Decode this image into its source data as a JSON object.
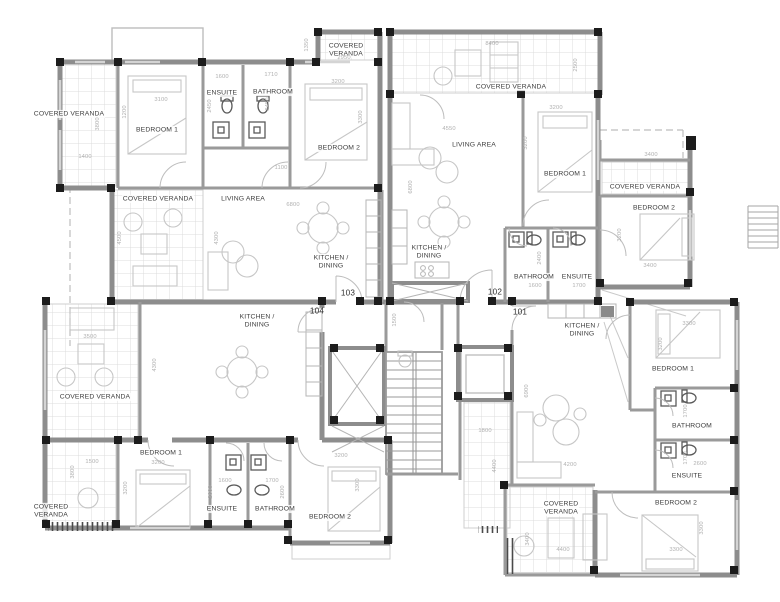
{
  "document": {
    "drawing_type": "apartment floor plan",
    "apartment_units": [
      "101",
      "102",
      "103",
      "104"
    ]
  },
  "colors": {
    "background": "#ffffff",
    "wall_gray": "#8d8d8d",
    "column_black": "#1c1c1c",
    "interior_wall": "#9a9a9a",
    "grid_gray": "#d9d9d9",
    "furniture_gray": "#c6c6c6",
    "dimension_text": "#b0b0b0",
    "room_text": "#3d3d3d"
  },
  "labels": {
    "rooms": [
      {
        "name": "apt103-covered-veranda-left",
        "text": "COVERED VERANDA",
        "x": 69,
        "y": 114
      },
      {
        "name": "apt103-bedroom1",
        "text": "BEDROOM 1",
        "x": 157,
        "y": 130
      },
      {
        "name": "apt103-ensuite",
        "text": "ENSUITE",
        "x": 222,
        "y": 93
      },
      {
        "name": "apt103-bathroom",
        "text": "BATHROOM",
        "x": 273,
        "y": 92
      },
      {
        "name": "apt103-bedroom2",
        "text": "BEDROOM 2",
        "x": 339,
        "y": 148
      },
      {
        "name": "apt103-covered-veranda-top",
        "text": "COVERED\nVERANDA",
        "x": 346,
        "y": 50
      },
      {
        "name": "apt103-covered-veranda-mid",
        "text": "COVERED VERANDA",
        "x": 158,
        "y": 199
      },
      {
        "name": "apt103-living-area",
        "text": "LIVING AREA",
        "x": 243,
        "y": 199
      },
      {
        "name": "apt103-kitchen-dining",
        "text": "KITCHEN /\nDINING",
        "x": 331,
        "y": 262
      },
      {
        "name": "apt102-covered-veranda-top",
        "text": "COVERED VERANDA",
        "x": 511,
        "y": 87
      },
      {
        "name": "apt102-living-area",
        "text": "LIVING AREA",
        "x": 474,
        "y": 145
      },
      {
        "name": "apt102-kitchen-dining",
        "text": "KITCHEN /\nDINING",
        "x": 429,
        "y": 252
      },
      {
        "name": "apt102-bedroom1",
        "text": "BEDROOM 1",
        "x": 565,
        "y": 174
      },
      {
        "name": "apt102-covered-veranda-right",
        "text": "COVERED VERANDA",
        "x": 645,
        "y": 187
      },
      {
        "name": "apt102-bedroom2",
        "text": "BEDROOM 2",
        "x": 654,
        "y": 208
      },
      {
        "name": "apt102-bathroom",
        "text": "BATHROOM",
        "x": 534,
        "y": 277
      },
      {
        "name": "apt102-ensuite",
        "text": "ENSUITE",
        "x": 577,
        "y": 277
      },
      {
        "name": "apt101-kitchen-dining",
        "text": "KITCHEN /\nDINING",
        "x": 582,
        "y": 330
      },
      {
        "name": "apt101-bedroom1",
        "text": "BEDROOM 1",
        "x": 673,
        "y": 369
      },
      {
        "name": "apt101-bathroom",
        "text": "BATHROOM",
        "x": 692,
        "y": 426
      },
      {
        "name": "apt101-ensuite",
        "text": "ENSUITE",
        "x": 687,
        "y": 476
      },
      {
        "name": "apt101-bedroom2",
        "text": "BEDROOM 2",
        "x": 676,
        "y": 503
      },
      {
        "name": "apt101-covered-veranda",
        "text": "COVERED\nVERANDA",
        "x": 561,
        "y": 508
      },
      {
        "name": "apt104-kitchen-dining",
        "text": "KITCHEN /\nDINING",
        "x": 257,
        "y": 321
      },
      {
        "name": "apt104-covered-veranda-mid",
        "text": "COVERED VERANDA",
        "x": 95,
        "y": 397
      },
      {
        "name": "apt104-bedroom1",
        "text": "BEDROOM 1",
        "x": 161,
        "y": 453
      },
      {
        "name": "apt104-ensuite",
        "text": "ENSUITE",
        "x": 222,
        "y": 509
      },
      {
        "name": "apt104-bathroom",
        "text": "BATHROOM",
        "x": 275,
        "y": 509
      },
      {
        "name": "apt104-bedroom2",
        "text": "BEDROOM 2",
        "x": 330,
        "y": 517
      },
      {
        "name": "apt104-covered-veranda-bottom",
        "text": "COVERED\nVERANDA",
        "x": 51,
        "y": 511
      }
    ],
    "units": [
      {
        "name": "unit-number-103",
        "text": "103",
        "x": 348,
        "y": 294
      },
      {
        "name": "unit-number-104",
        "text": "104",
        "x": 317,
        "y": 312
      },
      {
        "name": "unit-number-102",
        "text": "102",
        "x": 495,
        "y": 293
      },
      {
        "name": "unit-number-101",
        "text": "101",
        "x": 520,
        "y": 313
      }
    ],
    "dimensions": [
      {
        "text": "3100",
        "x": 161,
        "y": 100
      },
      {
        "text": "1200",
        "x": 125,
        "y": 112,
        "rot": "v"
      },
      {
        "text": "3800",
        "x": 98,
        "y": 124,
        "rot": "v"
      },
      {
        "text": "1400",
        "x": 85,
        "y": 157
      },
      {
        "text": "1600",
        "x": 222,
        "y": 77
      },
      {
        "text": "2450",
        "x": 210,
        "y": 106,
        "rot": "v"
      },
      {
        "text": "1710",
        "x": 271,
        "y": 75
      },
      {
        "text": "2450",
        "x": 268,
        "y": 104,
        "rot": "v"
      },
      {
        "text": "3200",
        "x": 338,
        "y": 82
      },
      {
        "text": "3300",
        "x": 361,
        "y": 117,
        "rot": "v"
      },
      {
        "text": "1100",
        "x": 281,
        "y": 168
      },
      {
        "text": "2950",
        "x": 344,
        "y": 58
      },
      {
        "text": "1350",
        "x": 307,
        "y": 45,
        "rot": "v"
      },
      {
        "text": "6800",
        "x": 293,
        "y": 205
      },
      {
        "text": "6800",
        "x": 411,
        "y": 187,
        "rot": "v"
      },
      {
        "text": "8400",
        "x": 492,
        "y": 44
      },
      {
        "text": "2500",
        "x": 576,
        "y": 65,
        "rot": "v"
      },
      {
        "text": "4550",
        "x": 449,
        "y": 129
      },
      {
        "text": "3200",
        "x": 556,
        "y": 108
      },
      {
        "text": "3200",
        "x": 526,
        "y": 143,
        "rot": "v"
      },
      {
        "text": "3400",
        "x": 651,
        "y": 155
      },
      {
        "text": "3200",
        "x": 620,
        "y": 235,
        "rot": "v"
      },
      {
        "text": "3400",
        "x": 650,
        "y": 266
      },
      {
        "text": "1600",
        "x": 535,
        "y": 286
      },
      {
        "text": "1700",
        "x": 579,
        "y": 286
      },
      {
        "text": "2400",
        "x": 540,
        "y": 258,
        "rot": "v"
      },
      {
        "text": "1500",
        "x": 395,
        "y": 320,
        "rot": "v"
      },
      {
        "text": "1800",
        "x": 485,
        "y": 431
      },
      {
        "text": "4400",
        "x": 495,
        "y": 466,
        "rot": "v"
      },
      {
        "text": "6900",
        "x": 527,
        "y": 391,
        "rot": "v"
      },
      {
        "text": "4200",
        "x": 570,
        "y": 465
      },
      {
        "text": "3300",
        "x": 689,
        "y": 324
      },
      {
        "text": "3200",
        "x": 661,
        "y": 344,
        "rot": "v"
      },
      {
        "text": "1700",
        "x": 686,
        "y": 411,
        "rot": "v"
      },
      {
        "text": "1700",
        "x": 686,
        "y": 458,
        "rot": "v"
      },
      {
        "text": "2600",
        "x": 700,
        "y": 464
      },
      {
        "text": "3300",
        "x": 702,
        "y": 528,
        "rot": "v"
      },
      {
        "text": "3300",
        "x": 676,
        "y": 550
      },
      {
        "text": "4400",
        "x": 563,
        "y": 550
      },
      {
        "text": "3400",
        "x": 528,
        "y": 539,
        "rot": "v"
      },
      {
        "text": "3500",
        "x": 90,
        "y": 337
      },
      {
        "text": "4500",
        "x": 120,
        "y": 238,
        "rot": "v"
      },
      {
        "text": "4300",
        "x": 217,
        "y": 238,
        "rot": "v"
      },
      {
        "text": "4300",
        "x": 155,
        "y": 365,
        "rot": "v"
      },
      {
        "text": "1500",
        "x": 92,
        "y": 462
      },
      {
        "text": "3200",
        "x": 158,
        "y": 463
      },
      {
        "text": "3200",
        "x": 126,
        "y": 488,
        "rot": "v"
      },
      {
        "text": "3800",
        "x": 73,
        "y": 472,
        "rot": "v"
      },
      {
        "text": "1600",
        "x": 225,
        "y": 481
      },
      {
        "text": "1700",
        "x": 272,
        "y": 481
      },
      {
        "text": "2600",
        "x": 211,
        "y": 492,
        "rot": "v"
      },
      {
        "text": "2600",
        "x": 283,
        "y": 492,
        "rot": "v"
      },
      {
        "text": "3200",
        "x": 341,
        "y": 456
      },
      {
        "text": "3300",
        "x": 358,
        "y": 485,
        "rot": "v"
      }
    ]
  }
}
